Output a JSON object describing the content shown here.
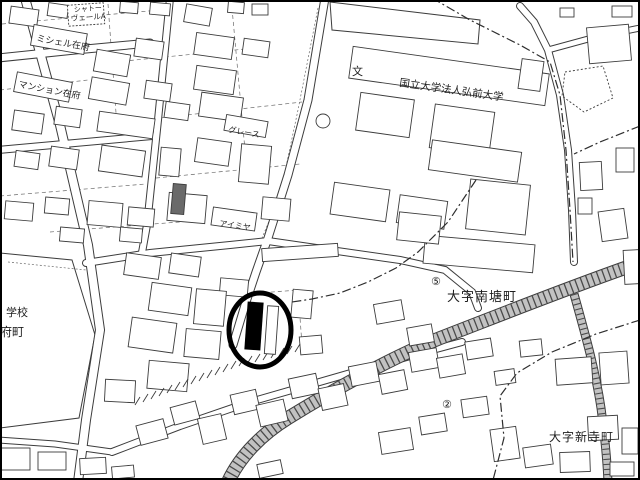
{
  "map": {
    "labels": {
      "apartment_line1": "シャトー",
      "apartment_line2": "ヴェールA",
      "michelle": "ミシェル在府",
      "mansion": "マンション在府",
      "university": "国立大学法人弘前大学",
      "school_symbol": "文",
      "grace": "グレース",
      "aimiya": "アイミヤ",
      "school_partial": "学校",
      "zaifucho_partial": "府町",
      "nantocho": "大字南塘町",
      "shinteramachi": "大字新寺町",
      "point5": "⑤",
      "point2": "②"
    },
    "marker": {
      "type": "highlight-circle-with-filled-building",
      "color": "#000000"
    },
    "colors": {
      "background": "#ffffff",
      "line": "#3c3c3c",
      "road_band_fill": "#c2c2c2",
      "band_hatch": "#4a4a4a",
      "border": "#000000"
    }
  }
}
